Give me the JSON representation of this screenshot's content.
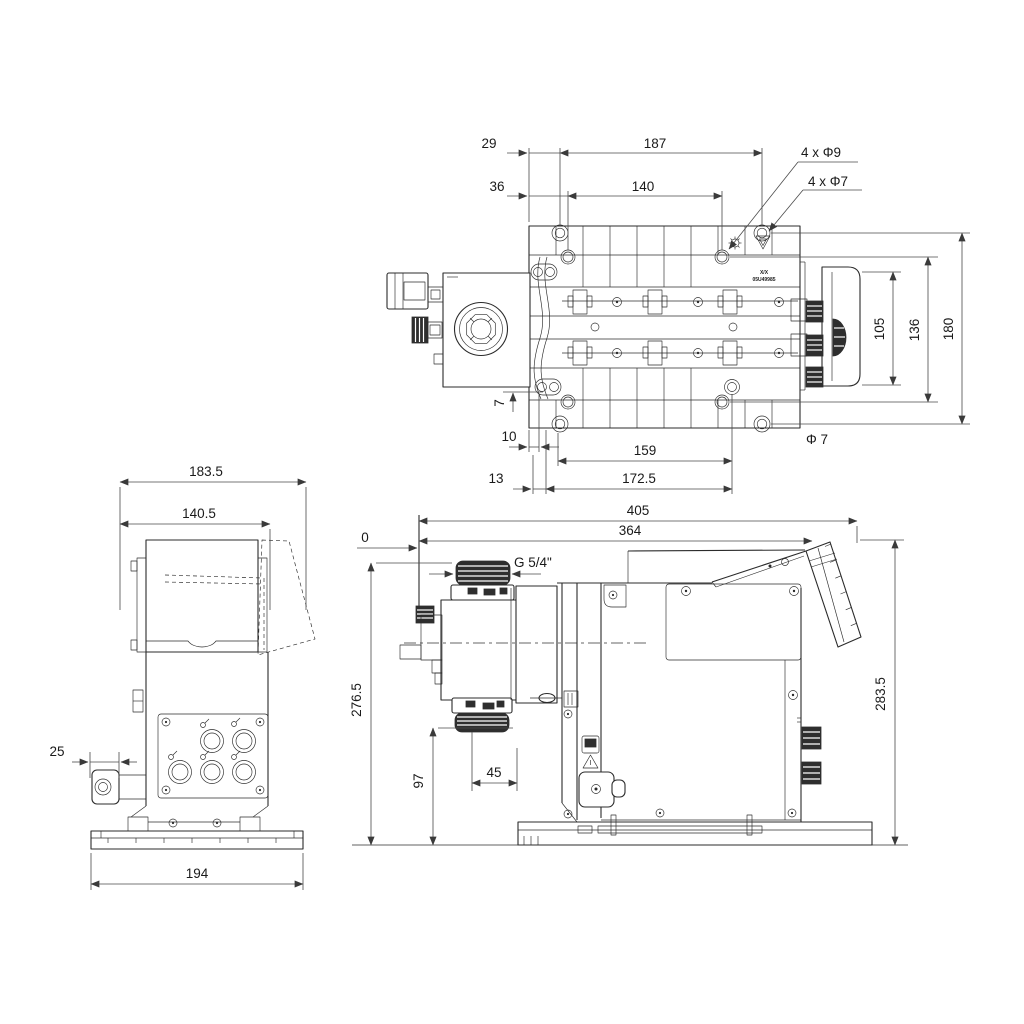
{
  "colors": {
    "background": "#ffffff",
    "line": "#2b2b2b",
    "dimension": "#4a4a4a",
    "text": "#1a1a1a"
  },
  "top_view": {
    "d_29": "29",
    "d_187": "187",
    "d_36": "36",
    "d_140": "140",
    "callout_holes_9": "4 x Φ9",
    "callout_holes_7": "4 x Φ7",
    "d_105": "105",
    "d_136": "136",
    "d_180": "180",
    "d_7": "7",
    "d_10": "10",
    "d_159": "159",
    "callout_dia_7": "Φ 7",
    "d_13": "13",
    "d_172_5": "172.5",
    "marking_line1": "X/X",
    "marking_line2": "05U49985"
  },
  "front_view": {
    "d_183_5": "183.5",
    "d_140_5": "140.5",
    "d_25": "25",
    "d_194": "194"
  },
  "side_view": {
    "d_405": "405",
    "d_364": "364",
    "d_0": "0",
    "thread_callout": "G 5/4\"",
    "d_276_5": "276.5",
    "d_283_5": "283.5",
    "d_97": "97",
    "d_45": "45"
  }
}
